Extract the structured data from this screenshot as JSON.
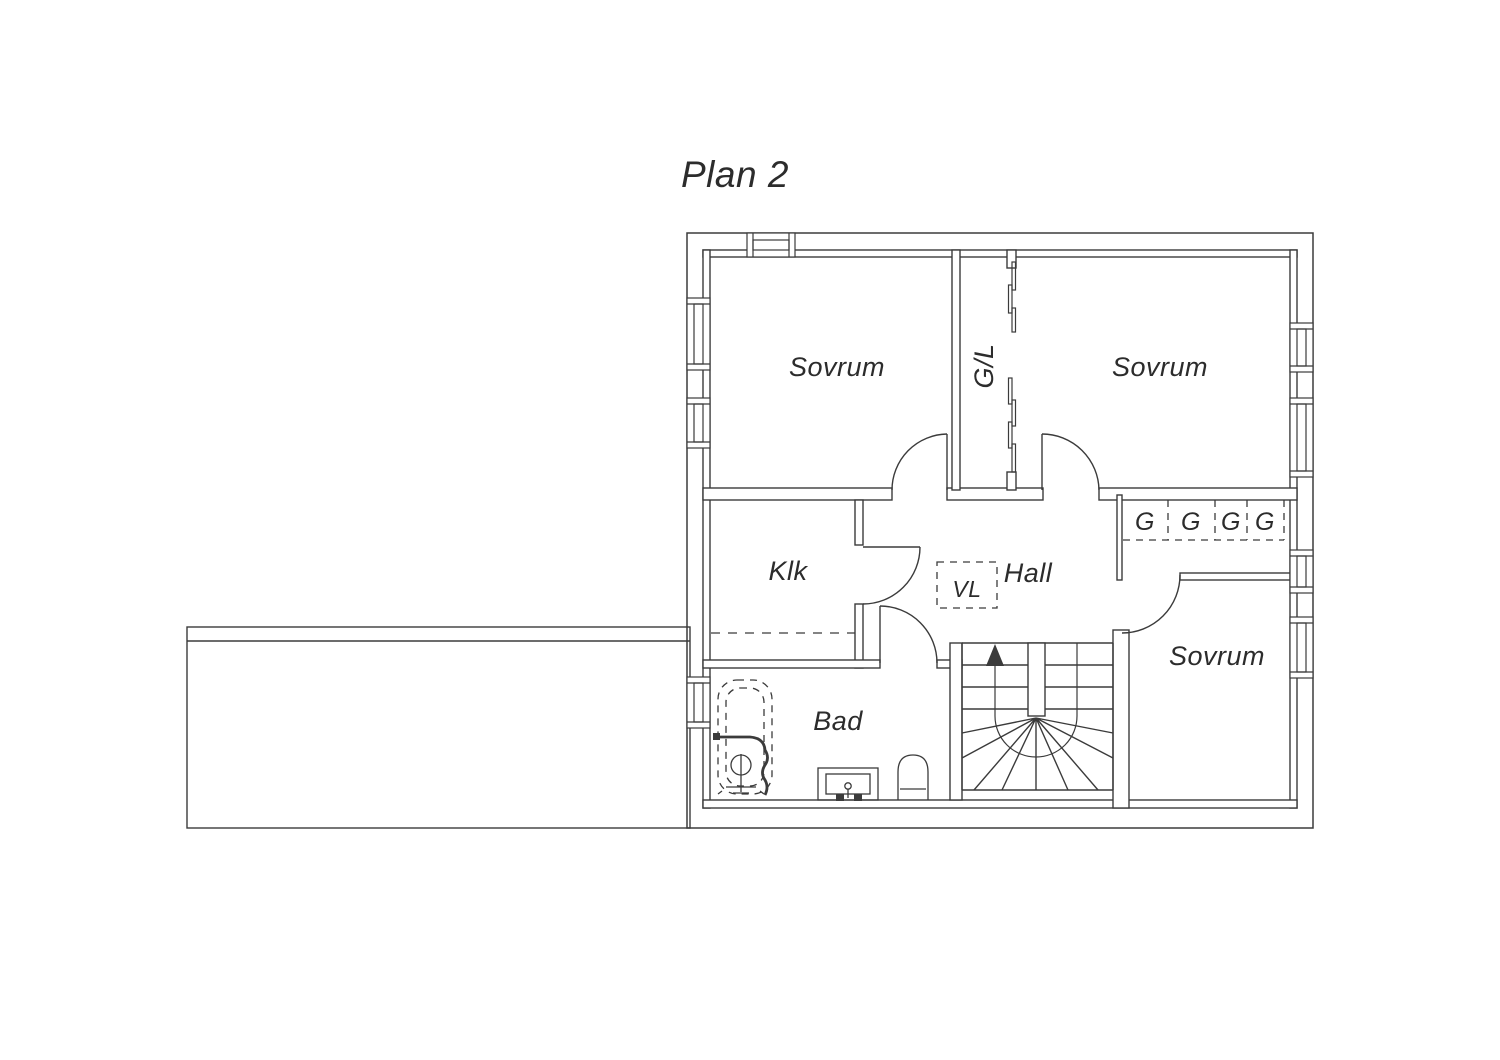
{
  "title": "Plan 2",
  "rooms": {
    "bedroom_top_left": "Sovrum",
    "bedroom_top_right": "Sovrum",
    "bedroom_right": "Sovrum",
    "linen_closet": "G/L",
    "walk_in_closet": "Klk",
    "hall": "Hall",
    "bathroom": "Bad",
    "ventilation": "VL"
  },
  "wardrobes": [
    "G",
    "G",
    "G",
    "G"
  ],
  "colors": {
    "line": "#3b3b3b",
    "text": "#2c2c2c",
    "background": "#ffffff"
  }
}
